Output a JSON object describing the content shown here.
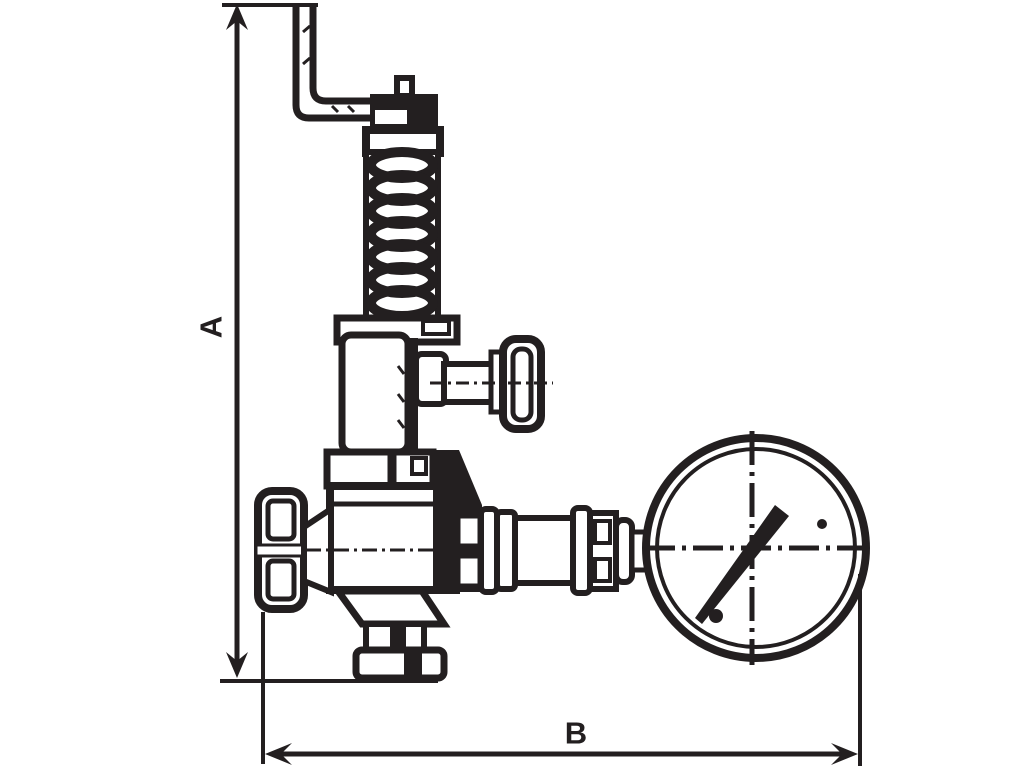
{
  "colors": {
    "ink": "#231f20",
    "paper": "#ffffff"
  },
  "dimensions": {
    "vertical": {
      "label": "A"
    },
    "horizontal": {
      "label": "B"
    }
  },
  "parts": [
    "lever-bracket",
    "adjusting-cap",
    "spring-housing",
    "bonnet",
    "side-outlet-knob",
    "bonnet-flange",
    "valve-body",
    "inlet-handwheel",
    "bottom-outlet-flange",
    "gauge-pipe-fittings",
    "pressure-gauge"
  ]
}
